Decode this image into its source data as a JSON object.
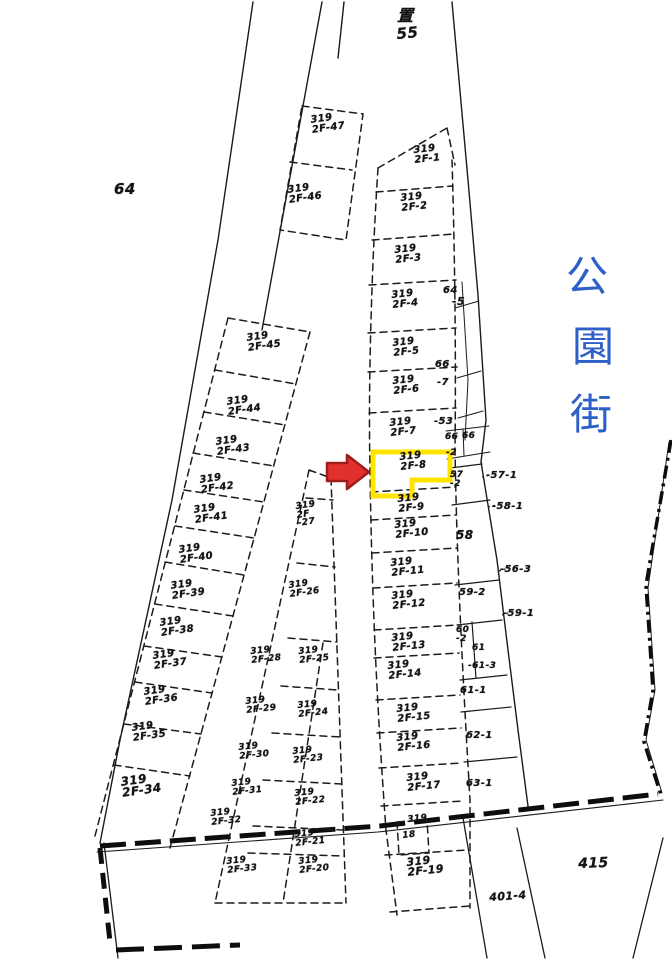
{
  "street_sign": {
    "name": "公園街",
    "chars": [
      "公",
      "園",
      "街"
    ],
    "color": "#2d5fc8"
  },
  "highlight": {
    "parcel": "319 2F-8",
    "box_color": "#ffe400",
    "arrow_color": "#e2312d",
    "arrow_outline": "#9c1d20"
  },
  "map_labels": [
    {
      "id": "top-symbol",
      "text": "置",
      "x": 397,
      "y": 8,
      "size": 16,
      "rot": 0
    },
    {
      "id": "block-55",
      "text": "55",
      "x": 396,
      "y": 27,
      "size": 15,
      "rot": -5
    },
    {
      "id": "area-64",
      "text": "64",
      "x": 114,
      "y": 182,
      "size": 15,
      "rot": 0
    },
    {
      "id": "parcel-319-2F-47",
      "text": "319\n2F-47",
      "x": 310,
      "y": 116,
      "size": 10,
      "rot": -8
    },
    {
      "id": "parcel-319-2F-46",
      "text": "319\n2F-46",
      "x": 287,
      "y": 186,
      "size": 10,
      "rot": -8
    },
    {
      "id": "parcel-319-2F-1",
      "text": "319\n2F-1",
      "x": 413,
      "y": 146,
      "size": 10,
      "rot": -6
    },
    {
      "id": "parcel-319-2F-2",
      "text": "319\n2F-2",
      "x": 400,
      "y": 194,
      "size": 10,
      "rot": -6
    },
    {
      "id": "parcel-319-2F-3",
      "text": "319\n2F-3",
      "x": 394,
      "y": 246,
      "size": 10,
      "rot": -6
    },
    {
      "id": "parcel-319-2F-4",
      "text": "319\n2F-4",
      "x": 391,
      "y": 291,
      "size": 10,
      "rot": -6
    },
    {
      "id": "parcel-319-2F-5",
      "text": "319\n2F-5",
      "x": 392,
      "y": 339,
      "size": 10,
      "rot": -6
    },
    {
      "id": "parcel-319-2F-6",
      "text": "319\n2F-6",
      "x": 392,
      "y": 377,
      "size": 10,
      "rot": -6
    },
    {
      "id": "parcel-319-2F-7",
      "text": "319\n2F-7",
      "x": 389,
      "y": 419,
      "size": 10,
      "rot": -6
    },
    {
      "id": "parcel-319-2F-8",
      "text": "319\n2F-8",
      "x": 399,
      "y": 453,
      "size": 10,
      "rot": -6
    },
    {
      "id": "parcel-319-2F-9",
      "text": "319\n2F-9",
      "x": 397,
      "y": 495,
      "size": 10,
      "rot": -6
    },
    {
      "id": "parcel-319-2F-10",
      "text": "319\n2F-10",
      "x": 394,
      "y": 521,
      "size": 10,
      "rot": -6
    },
    {
      "id": "parcel-319-2F-11",
      "text": "319\n2F-11",
      "x": 390,
      "y": 559,
      "size": 10,
      "rot": -6
    },
    {
      "id": "parcel-319-2F-12",
      "text": "319\n2F-12",
      "x": 391,
      "y": 592,
      "size": 10,
      "rot": -6
    },
    {
      "id": "parcel-319-2F-13",
      "text": "319\n2F-13",
      "x": 391,
      "y": 634,
      "size": 10,
      "rot": -6
    },
    {
      "id": "parcel-319-2F-14",
      "text": "319\n2F-14",
      "x": 387,
      "y": 662,
      "size": 10,
      "rot": -6
    },
    {
      "id": "parcel-319-2F-15",
      "text": "319\n2F-15",
      "x": 396,
      "y": 705,
      "size": 10,
      "rot": -6
    },
    {
      "id": "parcel-319-2F-16",
      "text": "319\n2F-16",
      "x": 396,
      "y": 734,
      "size": 10,
      "rot": -6
    },
    {
      "id": "parcel-319-2F-17",
      "text": "319\n2F-17",
      "x": 406,
      "y": 774,
      "size": 10,
      "rot": -6
    },
    {
      "id": "parcel-319-2F-18-a",
      "text": "319",
      "x": 407,
      "y": 816,
      "size": 9,
      "rot": -6
    },
    {
      "id": "parcel-319-2F-18-b",
      "text": "18",
      "x": 402,
      "y": 832,
      "size": 9,
      "rot": -6
    },
    {
      "id": "parcel-319-2F-19",
      "text": "319\n2F-19",
      "x": 406,
      "y": 858,
      "size": 11,
      "rot": -6
    },
    {
      "id": "parcel-319-2F-45",
      "text": "319\n2F-45",
      "x": 246,
      "y": 334,
      "size": 10,
      "rot": -8
    },
    {
      "id": "parcel-319-2F-44",
      "text": "319\n2F-44",
      "x": 226,
      "y": 398,
      "size": 10,
      "rot": -8
    },
    {
      "id": "parcel-319-2F-43",
      "text": "319\n2F-43",
      "x": 215,
      "y": 438,
      "size": 10,
      "rot": -8
    },
    {
      "id": "parcel-319-2F-42",
      "text": "319\n2F-42",
      "x": 199,
      "y": 476,
      "size": 10,
      "rot": -8
    },
    {
      "id": "parcel-319-2F-41",
      "text": "319\n2F-41",
      "x": 193,
      "y": 506,
      "size": 10,
      "rot": -8
    },
    {
      "id": "parcel-319-2F-40",
      "text": "319\n2F-40",
      "x": 178,
      "y": 546,
      "size": 10,
      "rot": -8
    },
    {
      "id": "parcel-319-2F-39",
      "text": "319\n2F-39",
      "x": 170,
      "y": 582,
      "size": 10,
      "rot": -8
    },
    {
      "id": "parcel-319-2F-38",
      "text": "319\n2F-38",
      "x": 159,
      "y": 619,
      "size": 10,
      "rot": -8
    },
    {
      "id": "parcel-319-2F-37",
      "text": "319\n2F-37",
      "x": 152,
      "y": 652,
      "size": 10,
      "rot": -8
    },
    {
      "id": "parcel-319-2F-36",
      "text": "319\n2F-36",
      "x": 143,
      "y": 688,
      "size": 10,
      "rot": -8
    },
    {
      "id": "parcel-319-2F-35",
      "text": "319\n2F-35",
      "x": 131,
      "y": 724,
      "size": 10,
      "rot": -8
    },
    {
      "id": "parcel-319-2F-34",
      "text": "319\n2F-34",
      "x": 120,
      "y": 777,
      "size": 12,
      "rot": -8
    },
    {
      "id": "parcel-319-2F-27",
      "text": "319\n2F\n-27",
      "x": 295,
      "y": 503,
      "size": 9,
      "rot": -8
    },
    {
      "id": "parcel-319-2F-26",
      "text": "319\n2F-26",
      "x": 288,
      "y": 582,
      "size": 9,
      "rot": -8
    },
    {
      "id": "parcel-319-2F-28",
      "text": "319\n2F-28",
      "x": 250,
      "y": 648,
      "size": 9,
      "rot": -6
    },
    {
      "id": "parcel-319-2F-25",
      "text": "319\n2F-25",
      "x": 298,
      "y": 648,
      "size": 9,
      "rot": -6
    },
    {
      "id": "parcel-319-2F-29",
      "text": "319\n2F-29",
      "x": 245,
      "y": 698,
      "size": 9,
      "rot": -6
    },
    {
      "id": "parcel-319-2F-24",
      "text": "319\n2F-24",
      "x": 297,
      "y": 702,
      "size": 9,
      "rot": -6
    },
    {
      "id": "parcel-319-2F-30",
      "text": "319\n2F-30",
      "x": 238,
      "y": 744,
      "size": 9,
      "rot": -6
    },
    {
      "id": "parcel-319-2F-23",
      "text": "319\n2F-23",
      "x": 292,
      "y": 748,
      "size": 9,
      "rot": -6
    },
    {
      "id": "parcel-319-2F-31",
      "text": "319\n2F-31",
      "x": 231,
      "y": 780,
      "size": 9,
      "rot": -6
    },
    {
      "id": "parcel-319-2F-22",
      "text": "319\n2F-22",
      "x": 294,
      "y": 790,
      "size": 9,
      "rot": -6
    },
    {
      "id": "parcel-319-2F-32",
      "text": "319\n2F-32",
      "x": 210,
      "y": 810,
      "size": 9,
      "rot": -6
    },
    {
      "id": "parcel-319-2F-21",
      "text": "319\n2F-21",
      "x": 294,
      "y": 831,
      "size": 9,
      "rot": -6
    },
    {
      "id": "parcel-319-2F-33",
      "text": "319\n2F-33",
      "x": 226,
      "y": 858,
      "size": 9,
      "rot": -6
    },
    {
      "id": "parcel-319-2F-20",
      "text": "319\n2F-20",
      "x": 298,
      "y": 858,
      "size": 9,
      "rot": -6
    },
    {
      "id": "sliver-64",
      "text": "64",
      "x": 443,
      "y": 286,
      "size": 10,
      "rot": 0
    },
    {
      "id": "sliver-5",
      "text": "-5",
      "x": 452,
      "y": 297,
      "size": 11,
      "rot": 0
    },
    {
      "id": "sliver-66",
      "text": "66",
      "x": 435,
      "y": 360,
      "size": 10,
      "rot": 0
    },
    {
      "id": "sliver-7",
      "text": "-7",
      "x": 437,
      "y": 378,
      "size": 10,
      "rot": 0
    },
    {
      "id": "sliver-53",
      "text": "-53",
      "x": 434,
      "y": 417,
      "size": 10,
      "rot": 0
    },
    {
      "id": "sliver-66b",
      "text": "66",
      "x": 445,
      "y": 433,
      "size": 9,
      "rot": 0
    },
    {
      "id": "sliver-66c",
      "text": "66",
      "x": 462,
      "y": 432,
      "size": 9,
      "rot": 0
    },
    {
      "id": "sliver-2",
      "text": "-2",
      "x": 446,
      "y": 449,
      "size": 9,
      "rot": 0
    },
    {
      "id": "cell-57-2",
      "text": "57\n-2",
      "x": 450,
      "y": 471,
      "size": 9,
      "rot": 0
    },
    {
      "id": "leader-57-1",
      "text": "-57-1",
      "x": 486,
      "y": 471,
      "size": 10,
      "rot": 0
    },
    {
      "id": "leader-58-1",
      "text": "-58-1",
      "x": 492,
      "y": 502,
      "size": 10,
      "rot": 0
    },
    {
      "id": "cell-58",
      "text": "58",
      "x": 456,
      "y": 530,
      "size": 12,
      "rot": 0
    },
    {
      "id": "leader-56-3",
      "text": "-56-3",
      "x": 500,
      "y": 565,
      "size": 10,
      "rot": 0
    },
    {
      "id": "cell-59-2",
      "text": "59-2",
      "x": 459,
      "y": 588,
      "size": 10,
      "rot": 0
    },
    {
      "id": "leader-59-1",
      "text": "-59-1",
      "x": 503,
      "y": 609,
      "size": 10,
      "rot": 0
    },
    {
      "id": "cell-60-2",
      "text": "60\n-2",
      "x": 456,
      "y": 626,
      "size": 9,
      "rot": 0
    },
    {
      "id": "cell-61",
      "text": "61",
      "x": 472,
      "y": 644,
      "size": 9,
      "rot": 0
    },
    {
      "id": "leader-61-3",
      "text": "-61-3",
      "x": 468,
      "y": 662,
      "size": 9,
      "rot": 0
    },
    {
      "id": "cell-61-1",
      "text": "61-1",
      "x": 460,
      "y": 686,
      "size": 10,
      "rot": 0
    },
    {
      "id": "cell-62-1",
      "text": "62-1",
      "x": 466,
      "y": 731,
      "size": 10,
      "rot": 0
    },
    {
      "id": "cell-63-1",
      "text": "63-1",
      "x": 466,
      "y": 779,
      "size": 10,
      "rot": 0
    },
    {
      "id": "road-401-4",
      "text": "401-4",
      "x": 489,
      "y": 893,
      "size": 11,
      "rot": -4
    },
    {
      "id": "area-415",
      "text": "415",
      "x": 578,
      "y": 858,
      "size": 14,
      "rot": -2
    }
  ]
}
